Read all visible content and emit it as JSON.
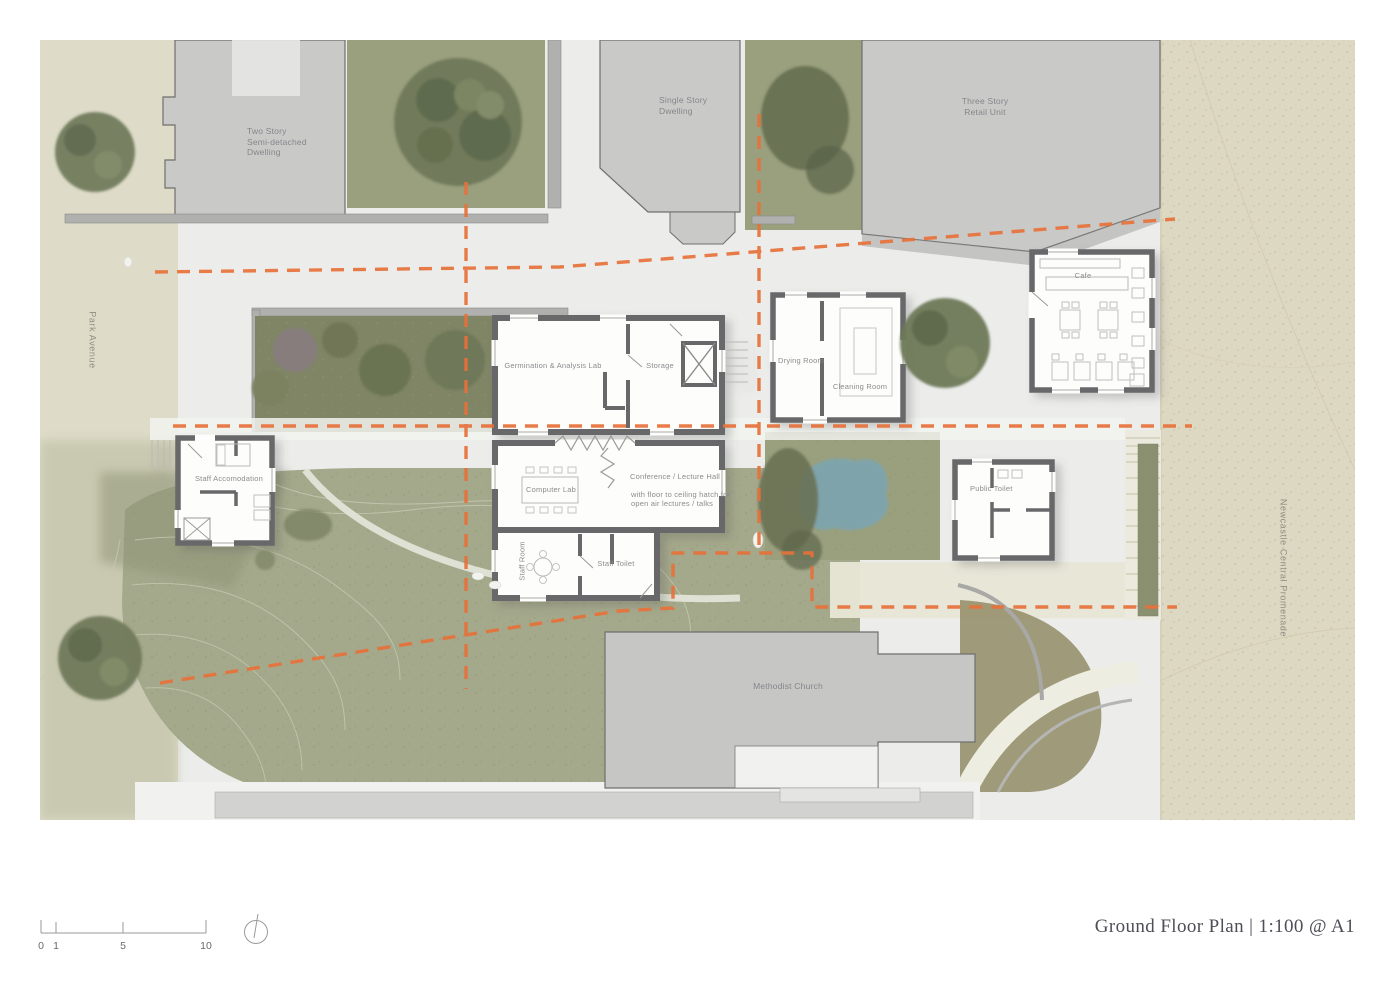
{
  "drawing": {
    "streets": {
      "left": "Park Avenue",
      "right": "Newcastle Central Promenade"
    },
    "context": {
      "two_story": [
        "Two Story",
        "Semi-detached",
        "Dwelling"
      ],
      "single_story": [
        "Single Story",
        "Dwelling"
      ],
      "retail": [
        "Three Story",
        "Retail Unit"
      ],
      "church": "Methodist Church"
    },
    "rooms": {
      "cafe": "Cafe",
      "germination_lab": "Germination & Analysis Lab",
      "storage": "Storage",
      "drying_room": "Drying Room",
      "cleaning_room": "Cleaning Room",
      "staff_accommodation": "Staff Accomodation",
      "computer_lab": "Computer Lab",
      "conference_hall": "Conference / Lecture Hall",
      "conference_note": [
        "with floor to ceiling hatch for",
        "open air lectures / talks"
      ],
      "staff_room": "Staff Room",
      "staff_toilet": "Staff Toilet",
      "public_toilet": "Public Toilet"
    }
  },
  "footer": {
    "title": "Ground Floor Plan | 1:100 @ A1",
    "scale": {
      "t0": "0",
      "t1": "1",
      "t5": "5",
      "t10": "10"
    }
  },
  "colors": {
    "section_line": "#e7713a",
    "proposal_wall": "#68686a",
    "context_building": "#c9cac8",
    "lawn": "#a5a98b",
    "garden_bed": "#7f8565",
    "pond": "#7da4ae",
    "promenade": "#ddd8c2",
    "paving": "#ecedeb",
    "label_text": "#85858a"
  }
}
